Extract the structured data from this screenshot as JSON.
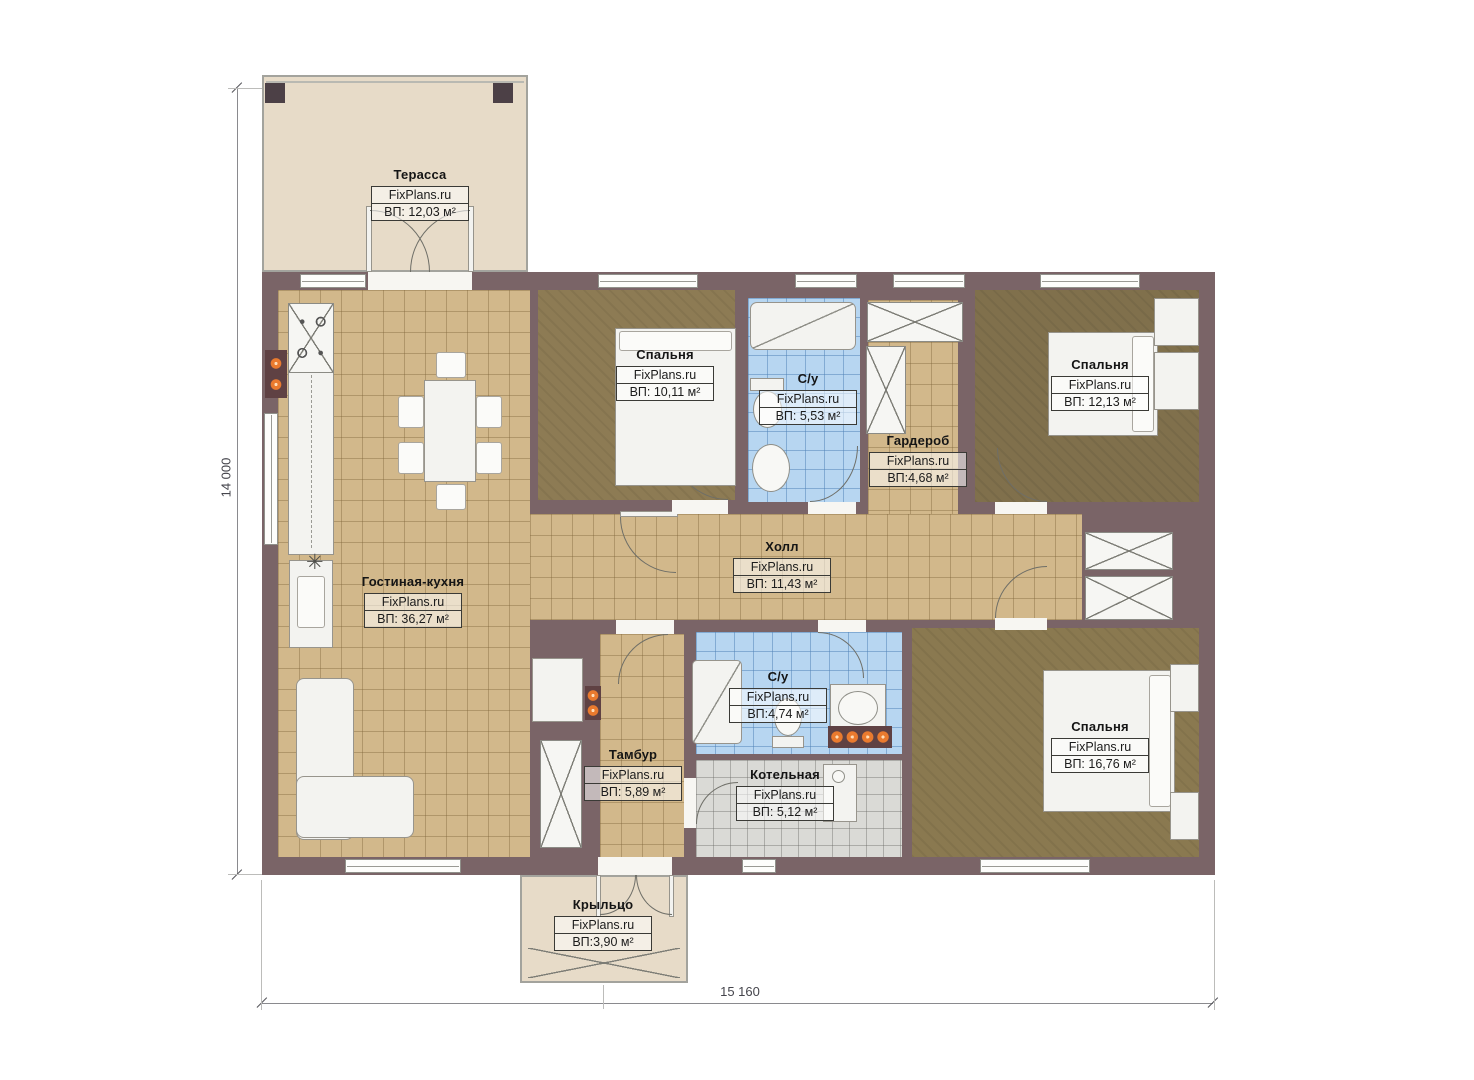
{
  "plan_title": "Single-storey house floor plan",
  "brand": "FixPlans.ru",
  "dimensions": {
    "height_label": "14 000",
    "width_label": "15 160"
  },
  "rooms": [
    {
      "id": "terrace",
      "name": "Терасса",
      "brand": "FixPlans.ru",
      "area": "ВП: 12,03 м²"
    },
    {
      "id": "bedroom-1",
      "name": "Спальня",
      "brand": "FixPlans.ru",
      "area": "ВП: 10,11 м²"
    },
    {
      "id": "bathroom-1",
      "name": "С/у",
      "brand": "FixPlans.ru",
      "area": "ВП: 5,53 м²"
    },
    {
      "id": "wardrobe",
      "name": "Гардероб",
      "brand": "FixPlans.ru",
      "area": "ВП:4,68 м²"
    },
    {
      "id": "bedroom-2",
      "name": "Спальня",
      "brand": "FixPlans.ru",
      "area": "ВП: 12,13 м²"
    },
    {
      "id": "hall",
      "name": "Холл",
      "brand": "FixPlans.ru",
      "area": "ВП: 11,43 м²"
    },
    {
      "id": "living-kitchen",
      "name": "Гостиная-кухня",
      "brand": "FixPlans.ru",
      "area": "ВП: 36,27 м²"
    },
    {
      "id": "bathroom-2",
      "name": "С/у",
      "brand": "FixPlans.ru",
      "area": "ВП:4,74 м²"
    },
    {
      "id": "vestibule",
      "name": "Тамбур",
      "brand": "FixPlans.ru",
      "area": "ВП: 5,89 м²"
    },
    {
      "id": "boiler-room",
      "name": "Котельная",
      "brand": "FixPlans.ru",
      "area": "ВП: 5,12 м²"
    },
    {
      "id": "bedroom-3",
      "name": "Спальня",
      "brand": "FixPlans.ru",
      "area": "ВП: 16,76 м²"
    },
    {
      "id": "porch",
      "name": "Крыльцо",
      "brand": "FixPlans.ru",
      "area": "ВП:3,90 м²"
    }
  ],
  "symbols": {
    "fan_symbol": "✳"
  },
  "colors": {
    "wall": "#7a6467",
    "tile_tan": "#d2b88b",
    "tile_blue": "#b7d6f1",
    "tile_gray": "#dadad6",
    "carpet": "#8a7950",
    "deck": "#e7dbc8",
    "radiator_dot": "#ea7a2e"
  }
}
